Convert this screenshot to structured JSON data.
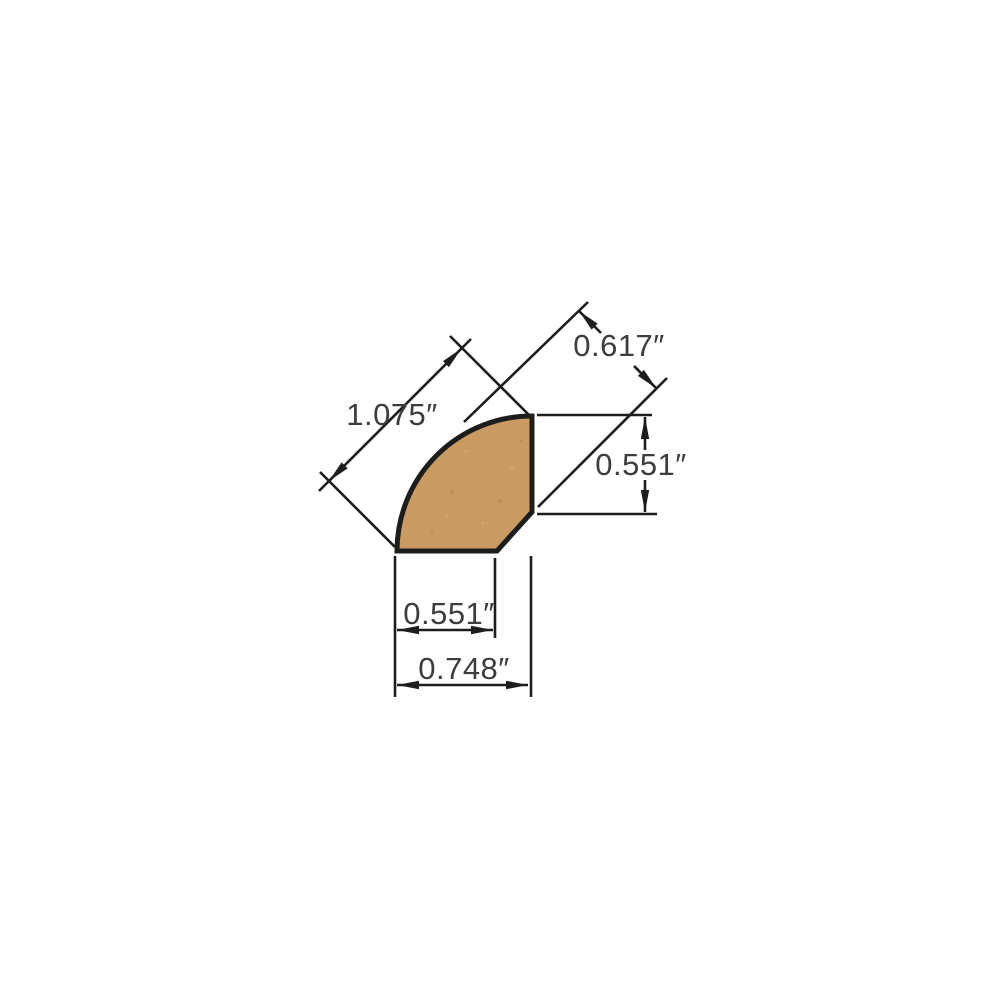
{
  "diagram": {
    "type": "technical-profile-drawing",
    "subject": "quarter-round moulding cross-section",
    "units": "inches",
    "colors": {
      "background": "#ffffff",
      "profile_fill": "#c99b63",
      "profile_speckle_dark": "#b5864e",
      "profile_speckle_light": "#d9b27c",
      "line": "#1d1d1b",
      "text": "#3d3d3d"
    },
    "dimensions": [
      {
        "id": "curve-face-diagonal",
        "label": "1.075″",
        "value": 1.075
      },
      {
        "id": "top-right-diagonal",
        "label": "0.617″",
        "value": 0.617
      },
      {
        "id": "right-side-height",
        "label": "0.551″",
        "value": 0.551
      },
      {
        "id": "bottom-inner-width",
        "label": "0.551″",
        "value": 0.551
      },
      {
        "id": "bottom-overall-width",
        "label": "0.748″",
        "value": 0.748
      }
    ]
  }
}
